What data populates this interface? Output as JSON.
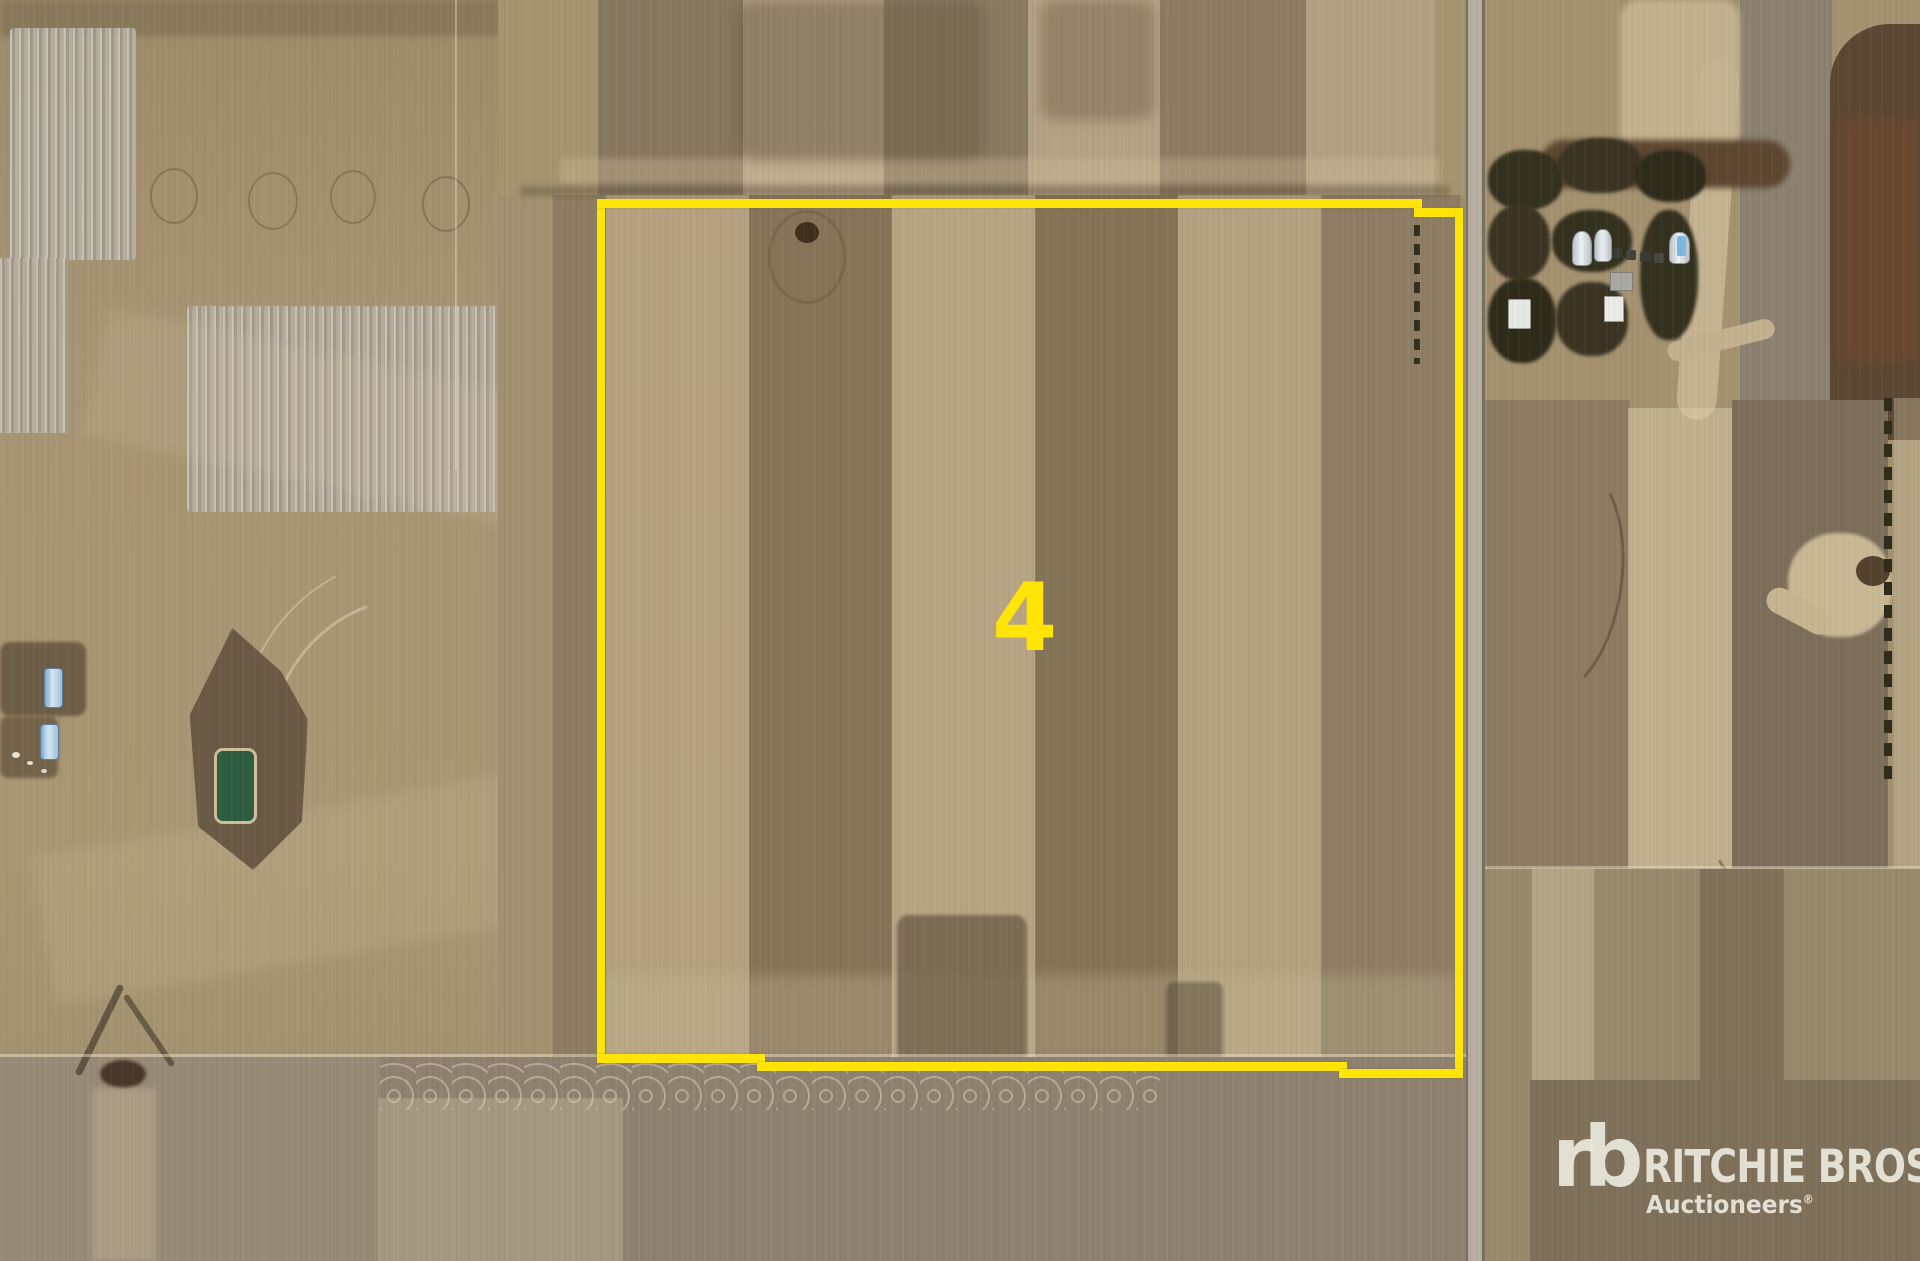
{
  "map": {
    "parcel": {
      "label": "4"
    },
    "branding": {
      "monogram": "rb",
      "wordmark": "RITCHIE BROS.",
      "tagline": "Auctioneers",
      "registered_mark": "®"
    },
    "colors": {
      "parcel_boundary": "#FFE408",
      "parcel_label": "#FFE408",
      "logo_text": "#E9E5DB"
    }
  }
}
